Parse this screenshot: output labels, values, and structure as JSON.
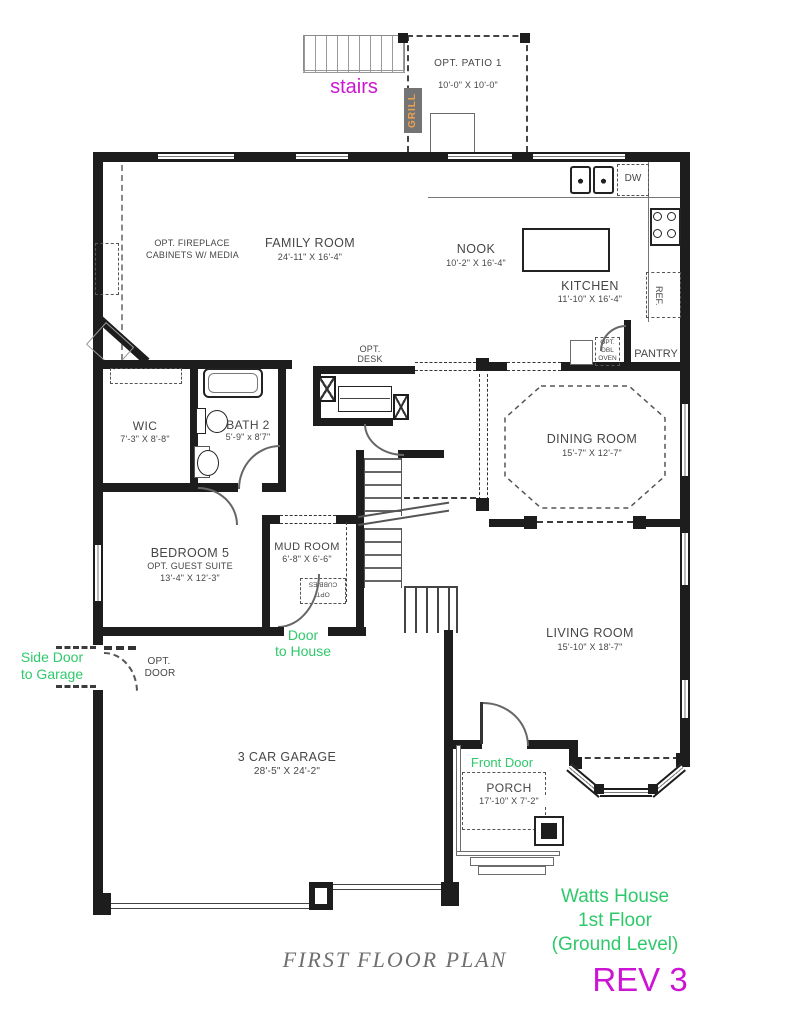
{
  "rooms": {
    "family": {
      "name": "FAMILY ROOM",
      "dims": "24'-11\" X 16'-4\""
    },
    "nook": {
      "name": "NOOK",
      "dims": "10'-2\" X 16'-4\""
    },
    "kitchen": {
      "name": "KITCHEN",
      "dims": "11'-10\" X 16'-4\""
    },
    "dining": {
      "name": "DINING ROOM",
      "dims": "15'-7\" X 12'-7\""
    },
    "living": {
      "name": "LIVING ROOM",
      "dims": "15'-10\" X 18'-7\""
    },
    "wic": {
      "name": "WIC",
      "dims": "7'-3\" X 8'-8\""
    },
    "bath2": {
      "name": "BATH 2",
      "dims": "5'-9\" x 8'7\""
    },
    "bedroom5": {
      "name": "BEDROOM 5",
      "sub": "OPT. GUEST SUITE",
      "dims": "13'-4\" X 12'-3\""
    },
    "mudroom": {
      "name": "MUD ROOM",
      "dims": "6'-8\" X 6'-6\""
    },
    "garage": {
      "name": "3 CAR GARAGE",
      "dims": "28'-5\" X 24'-2\""
    },
    "porch": {
      "name": "PORCH",
      "dims": "17'-10\" X 7'-2\""
    },
    "patio": {
      "name": "OPT. PATIO 1",
      "dims": "10'-0\" X 10'-0\""
    }
  },
  "labels": {
    "fireplace_l1": "OPT. FIREPLACE",
    "fireplace_l2": "CABINETS W/ MEDIA",
    "opt_desk_l1": "OPT.",
    "opt_desk_l2": "DESK",
    "opt_door_l1": "OPT.",
    "opt_door_l2": "DOOR",
    "cubbies_l1": "OPT",
    "cubbies_l2": "CUBBIES",
    "dw": "DW",
    "ref": "REF.",
    "pantry": "PANTRY",
    "oven_l1": "OPT.",
    "oven_l2": "DBL",
    "oven_l3": "OVEN",
    "grill": "GRILL"
  },
  "annotations": {
    "stairs": "stairs",
    "side_door_l1": "Side Door",
    "side_door_l2": "to Garage",
    "door_house_l1": "Door",
    "door_house_l2": "to House",
    "front_door": "Front Door",
    "house_l1": "Watts House",
    "house_l2": "1st Floor",
    "house_l3": "(Ground Level)",
    "rev": "REV 3"
  },
  "footer": {
    "plan_title": "FIRST FLOOR PLAN"
  },
  "colors": {
    "annotation_green": "#2fc96b",
    "annotation_magenta": "#cc15d4",
    "grill_bg": "#747474",
    "grill_text": "#efa24e",
    "wall": "#1d1d1d",
    "label_gray": "#464646",
    "plan_title_gray": "#6e6e6e"
  }
}
